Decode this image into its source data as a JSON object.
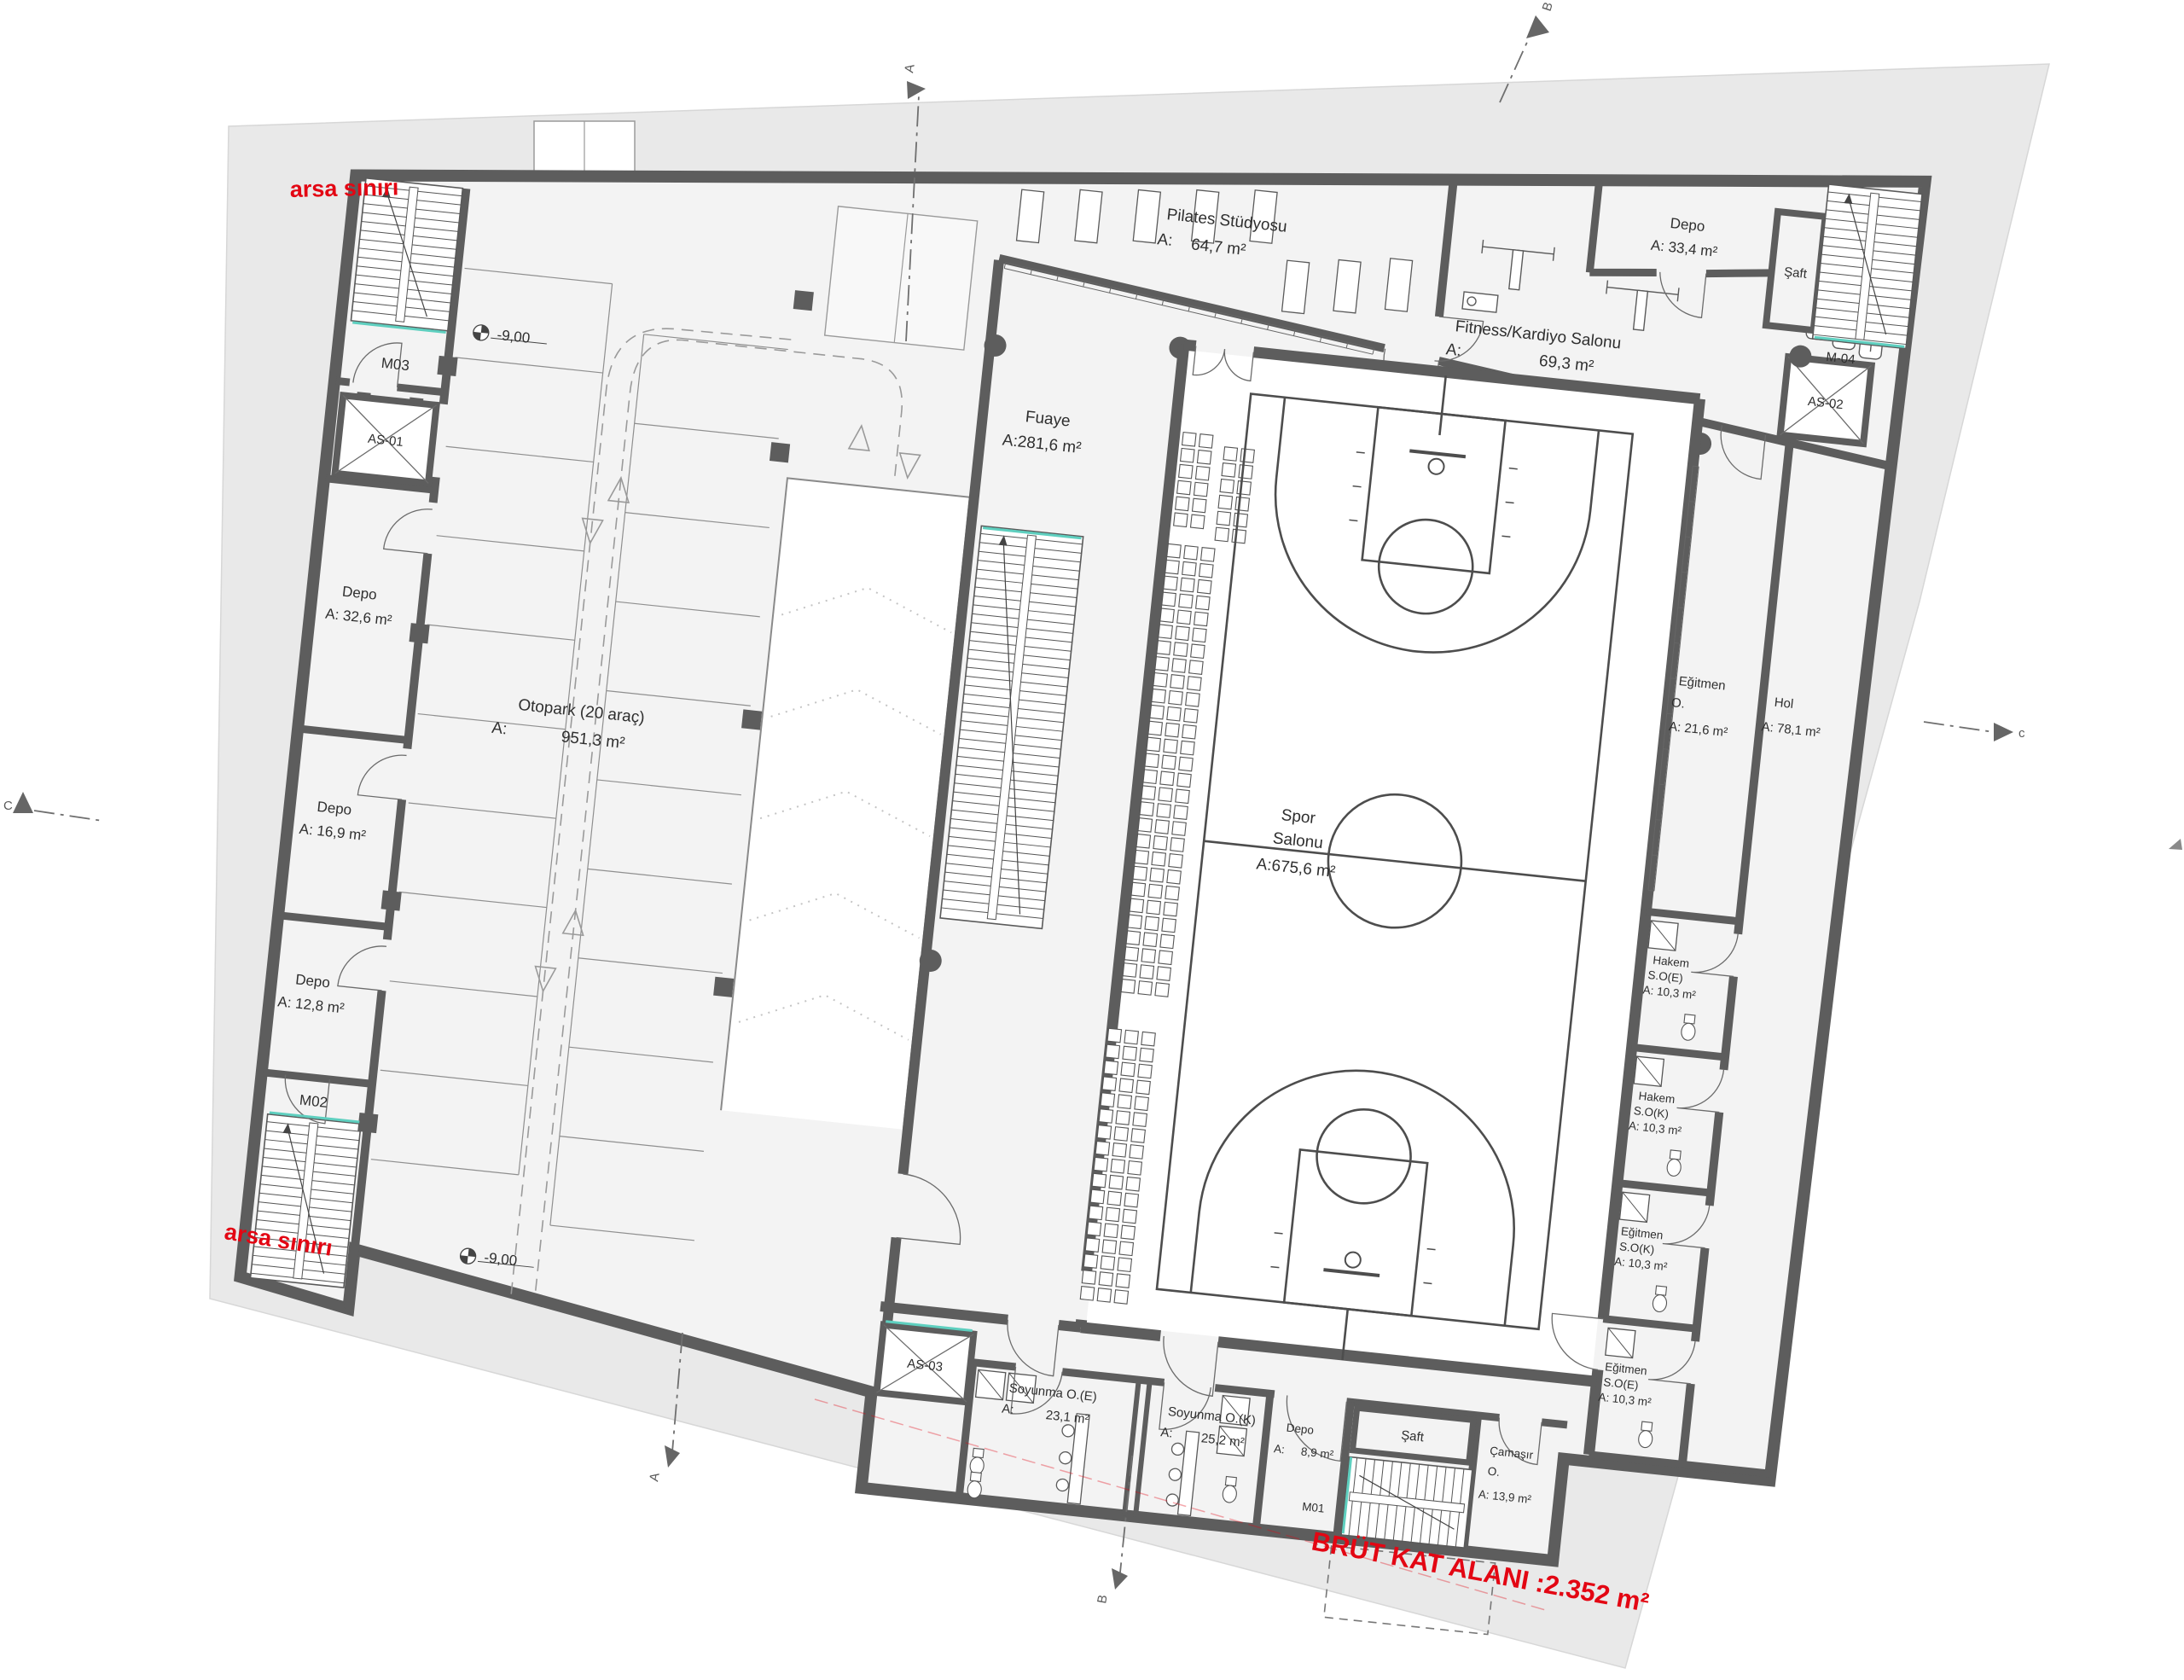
{
  "colors": {
    "red": "#e30613",
    "wall": "#5d5d5d",
    "site": "#e9e9e9",
    "floor": "#f3f3f3",
    "hall": "#ffffff"
  },
  "site": {
    "type": "architectural basement floor plan",
    "language": "Turkish"
  },
  "labels": {
    "arsa_top": "arsa sınırı",
    "arsa_bottom": "arsa sınırı",
    "brut": "BRÜT KAT ALANI :2.352 m²",
    "m03": "M03",
    "m02": "M02",
    "m01": "M01",
    "m04": "M-04",
    "as01": "AS-01",
    "as02": "AS-02",
    "as03": "AS-03",
    "depo": "Depo",
    "depo_326": "A: 32,6 m²",
    "depo_169": "A: 16,9 m²",
    "depo_128": "A: 12,8 m²",
    "depo_334": "A: 33,4 m²",
    "otopark": "Otopark (20 araç)",
    "a": "A:",
    "otopark_area": "951,3 m²",
    "level": "-9,00",
    "pilates": "Pilates Stüdyosu",
    "pilates_area": "64,7 m²",
    "fitness": "Fitness/Kardiyo Salonu",
    "fitness_area": "69,3 m²",
    "saft": "Şaft",
    "fuaye": "Fuaye",
    "fuaye_area": "A:281,6 m²",
    "spor": "Spor",
    "salonu": "Salonu",
    "spor_area": "A:675,6 m²",
    "egitmen": "Eğitmen",
    "o_dot": "O.",
    "egitmen_area": "A: 21,6 m²",
    "hol": "Hol",
    "hol_area": "A: 78,1 m²",
    "hakem": "Hakem",
    "soe": "S.O(E)",
    "sok": "S.O(K)",
    "so_area": "A: 10,3 m²",
    "soyunma_e": "Soyunma O.(E)",
    "soyunma_e_area": "23,1 m²",
    "soyunma_k": "Soyunma O.(K)",
    "soyunma_k_area": "25,2 m²",
    "depo_89": "8,9 m²",
    "camasir": "Çamaşır",
    "camasir_area": "A: 13,9 m²",
    "sec_a": "A",
    "sec_b": "B",
    "sec_c": "C",
    "sec_c_small": "c"
  }
}
